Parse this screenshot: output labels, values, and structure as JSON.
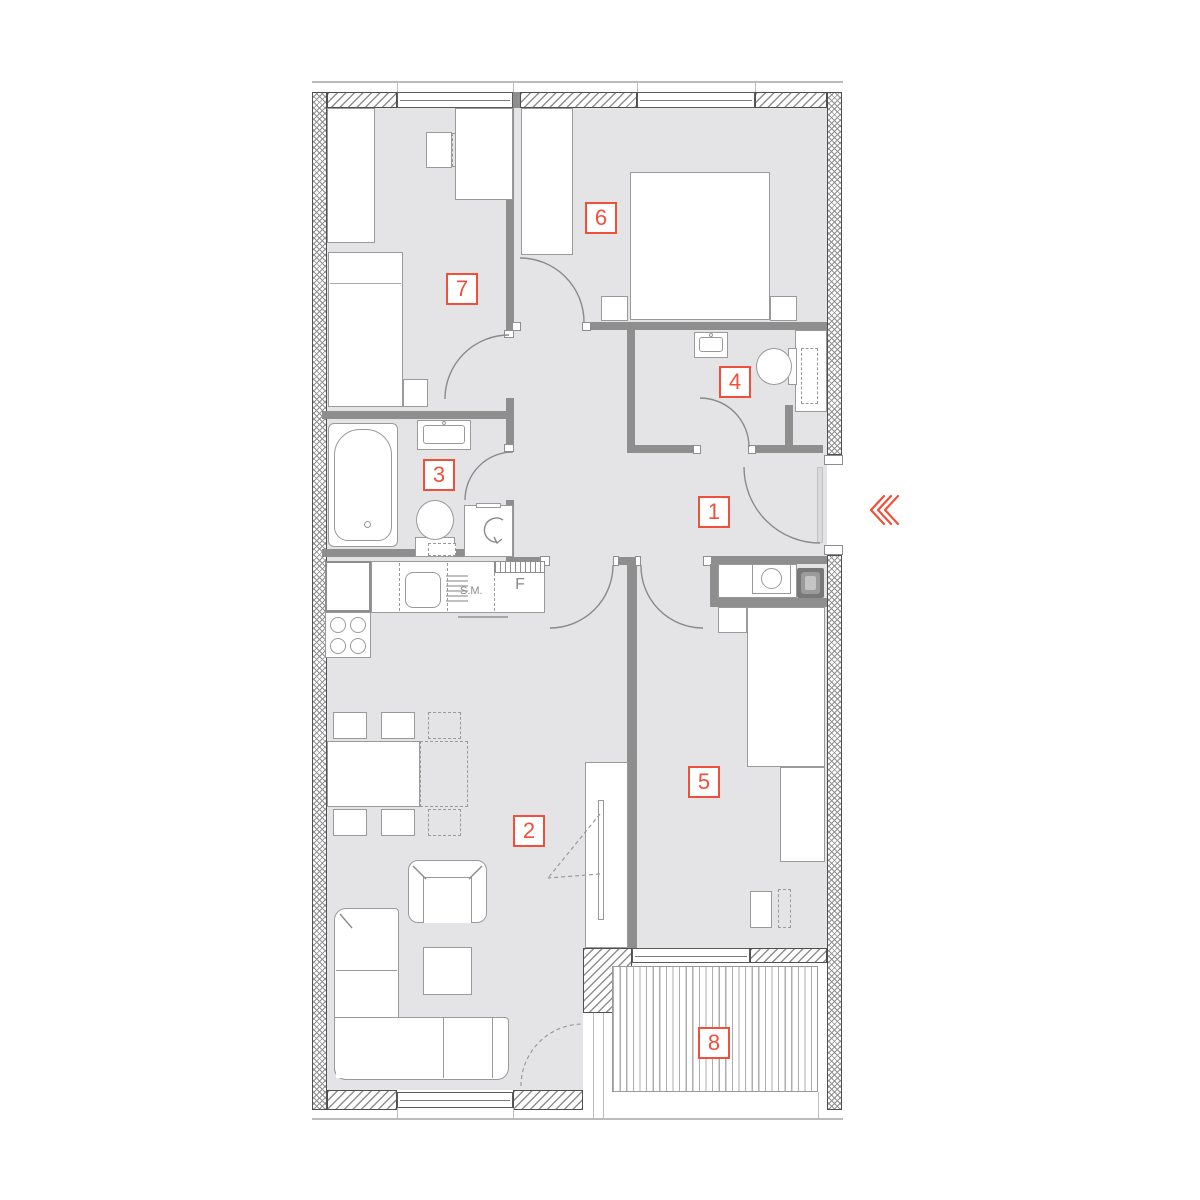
{
  "plan": {
    "title": "apartment-floor-plan",
    "rooms": [
      {
        "number": "1",
        "name": "hallway"
      },
      {
        "number": "2",
        "name": "living-room-kitchen"
      },
      {
        "number": "3",
        "name": "bathroom"
      },
      {
        "number": "4",
        "name": "toilet"
      },
      {
        "number": "5",
        "name": "bedroom"
      },
      {
        "number": "6",
        "name": "bedroom"
      },
      {
        "number": "7",
        "name": "bedroom"
      },
      {
        "number": "8",
        "name": "balcony"
      }
    ],
    "kitchen": {
      "dishwasher_label": "S.M.",
      "fridge_label": "F"
    },
    "entrance": {
      "icon": "left-chevrons"
    },
    "colors": {
      "accent": "#f0503a",
      "wall": "#8e8e8e",
      "floor": "#e4e4e6"
    }
  }
}
